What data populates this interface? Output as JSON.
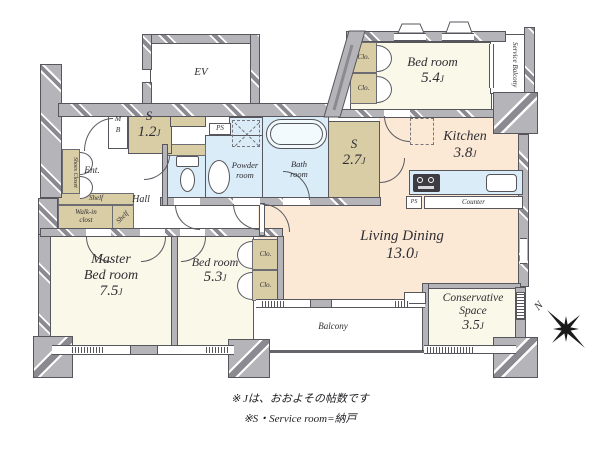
{
  "floorplan": {
    "unit": "J",
    "rooms": {
      "ev": {
        "name": "EV"
      },
      "s12": {
        "name": "S",
        "size": "1.2"
      },
      "bedroom54": {
        "name": "Bed room",
        "size": "5.4"
      },
      "kitchen": {
        "name": "Kitchen",
        "size": "3.8"
      },
      "s27": {
        "name": "S",
        "size": "2.7"
      },
      "living_dining": {
        "name": "Living Dining",
        "size": "13.0"
      },
      "master_bedroom": {
        "name_line1": "Master",
        "name_line2": "Bed room",
        "size": "7.5"
      },
      "bedroom53": {
        "name": "Bed room",
        "size": "5.3"
      },
      "conservative": {
        "name_line1": "Conservative",
        "name_line2": "Space",
        "size": "3.5"
      },
      "bath": {
        "name_line1": "Bath",
        "name_line2": "room"
      },
      "powder": {
        "name_line1": "Powder",
        "name_line2": "room"
      },
      "entrance": {
        "name": "Ent."
      },
      "hall": {
        "name": "Hall"
      },
      "balcony": {
        "name": "Balcony"
      },
      "service_balcony": {
        "name": "Service Balcony"
      },
      "walk_in_closet": {
        "name_line1": "Walk-in",
        "name_line2": "clost"
      }
    },
    "labels": {
      "clo": "Clo.",
      "shelf": "Shelf",
      "shoes_closet": "Shoes Closet",
      "ps": "PS",
      "mb_m": "M",
      "mb_b": "B",
      "counter": "Counter",
      "north": "N"
    },
    "notes": {
      "line1": "※ Jは、おおよその帖数です",
      "line2": "※S・Service room=納戸"
    },
    "colors": {
      "wall": "#b5b4b8",
      "room_cream": "#faf8e9",
      "room_peach": "#fbe9d6",
      "wet_blue": "#daecf7",
      "storage_tan": "#d9cda6"
    }
  }
}
